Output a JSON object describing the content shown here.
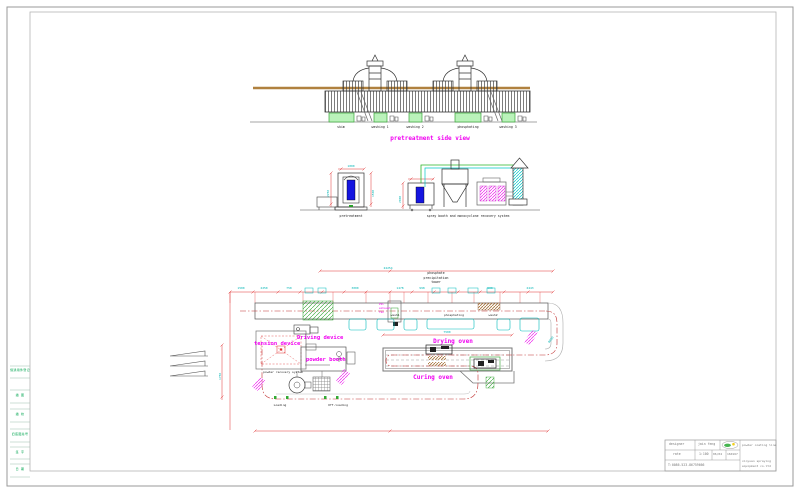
{
  "drawing": {
    "side_view": {
      "title": "pretreatment side view",
      "tank_labels": [
        "skim",
        "washing 1",
        "washing 2",
        "phosphating",
        "washing 3"
      ]
    },
    "elevation": {
      "left_label": "pretreatment",
      "right_label": "spray booth and monocyclone recovery system",
      "dims": {
        "d1": "2250",
        "d2": "1500",
        "d3": "1000",
        "d4": "2000"
      }
    },
    "plan": {
      "labels": {
        "phosphate_tower_1": "phosphate",
        "phosphate_tower_2": "precipitation",
        "phosphate_tower_3": "tower",
        "wash1": "wash1",
        "phosphating": "phosphating",
        "wash2": "wash2",
        "pvc_1": "PVC",
        "pvc_2": "exhaust",
        "pvc_3": "fan",
        "driving_device": "Driving device",
        "tension_device": "tension device",
        "powder_booth": "powder booth",
        "powder_recovery": "powder recovery system",
        "drying_oven": "Drying oven",
        "curing_oven": "Curing oven",
        "loading": "Loading",
        "offloading": "Off-loading"
      },
      "dims": {
        "overall_top": "24254",
        "row": [
          "1500",
          "2250",
          "750",
          "3000",
          "1478",
          "998",
          "900",
          "2443"
        ],
        "left_vert": "1750",
        "radius": "R600",
        "oven_len": "7500"
      }
    }
  },
  "sheet": {
    "left_strip": [
      "借通用件登记",
      "描 图",
      "描 校",
      "旧底图总号",
      "签 字",
      "日 期"
    ],
    "title_block": {
      "designer_label": "designer",
      "designer_name": "jain feng",
      "scale_label": "rate",
      "scale_value": "1:100",
      "date_value": "06/04",
      "sheet_no": "160167",
      "project": "powder coating line",
      "company_1": "xinyuan spraying",
      "company_2": "equipment co.ltd",
      "phone": "T:0086-523-86759666"
    }
  },
  "colors": {
    "magenta": "#f000f0",
    "cad_green": "#00a550",
    "cyan": "#00b4b4",
    "dim_red": "#e03030",
    "brown": "#a8763e"
  }
}
